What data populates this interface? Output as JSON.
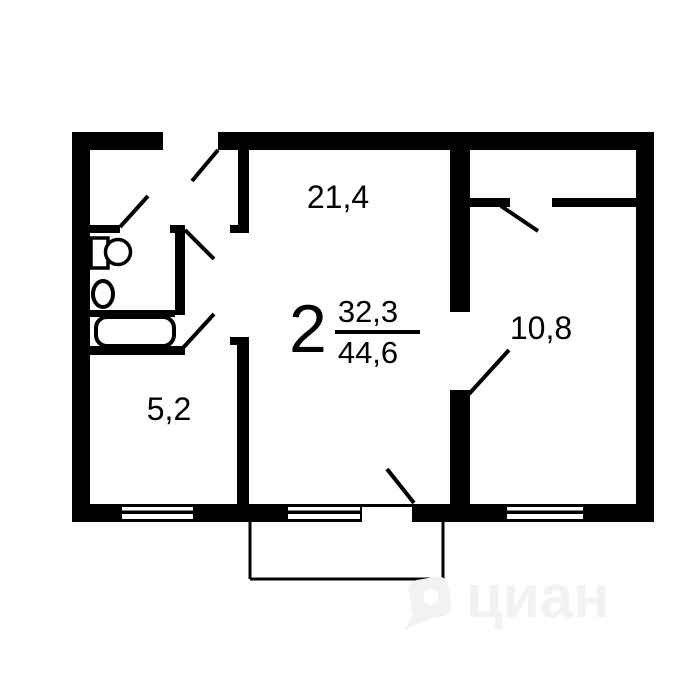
{
  "floor_plan": {
    "kind": "apartment-floor-plan",
    "summary": {
      "room_count": "2",
      "living_area": "32,3",
      "total_area": "44,6"
    },
    "rooms": [
      {
        "id": "living-room",
        "area_label": "21,4"
      },
      {
        "id": "bedroom",
        "area_label": "10,8"
      },
      {
        "id": "kitchen",
        "area_label": "5,2"
      }
    ],
    "watermark": {
      "text": "циан"
    },
    "icons": [
      "sink-icon",
      "toilet-icon",
      "bathtub-icon",
      "door-swing-icon",
      "window-icon",
      "balcony-outline",
      "cian-logo-icon"
    ],
    "colors": {
      "walls": "#000000",
      "background": "#ffffff",
      "watermark": "#f2f2f2"
    }
  }
}
